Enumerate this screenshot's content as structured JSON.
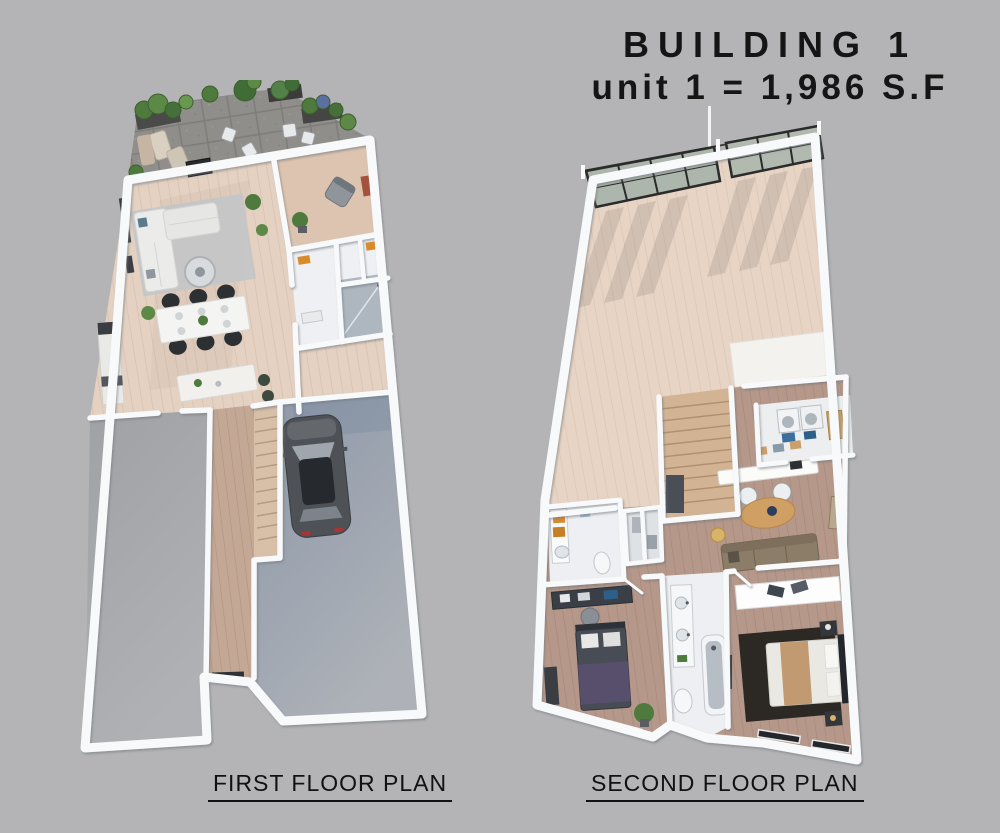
{
  "title": {
    "line1": "BUILDING 1",
    "line2": "unit 1 = 1,986 S.F"
  },
  "floor_plans": [
    {
      "id": "first",
      "label": "FIRST FLOOR PLAN",
      "rooms": [
        "terrace",
        "living-room",
        "den",
        "dining-area",
        "kitchen",
        "bathroom",
        "hallway",
        "stairs",
        "garage",
        "driveway-bay"
      ],
      "furniture_icons": [
        "potted-plant-icon",
        "lounge-chair-icon",
        "fire-table-icon",
        "sectional-sofa-icon",
        "coffee-table-icon",
        "dining-table-icon",
        "dining-chair-icon",
        "kitchen-island-icon",
        "shower-icon",
        "staircase-icon",
        "car-icon",
        "entry-door-icon"
      ]
    },
    {
      "id": "second",
      "label": "SECOND FLOOR PLAN",
      "rooms": [
        "open-room",
        "stairwell",
        "laundry-room",
        "office-nook",
        "family-area",
        "bathroom",
        "hall-closets",
        "bedroom",
        "middle-bathroom",
        "master-bedroom"
      ],
      "furniture_icons": [
        "window-wall-icon",
        "washer-dryer-icon",
        "desk-icon",
        "office-chair-icon",
        "sofa-icon",
        "oval-table-icon",
        "floor-lamp-icon",
        "vanity-icon",
        "bed-icon",
        "bathtub-icon",
        "toilet-icon",
        "nightstand-icon",
        "rug-icon",
        "potted-plant-icon"
      ]
    }
  ],
  "colors": {
    "background": "#b4b4b6",
    "wall": "#f8f9fb",
    "wood_light": "#e4d1c1",
    "wood_dark": "#b5988a",
    "terrace_pavers": "#8e8d89",
    "garage_floor": "#95a0b0",
    "driveway": "#a6a8ac",
    "tile": "#edeff2",
    "car_body": "#4e5257",
    "plant_green": "#4e7a3d",
    "accent_orange": "#d98a2b",
    "text": "#151515"
  }
}
